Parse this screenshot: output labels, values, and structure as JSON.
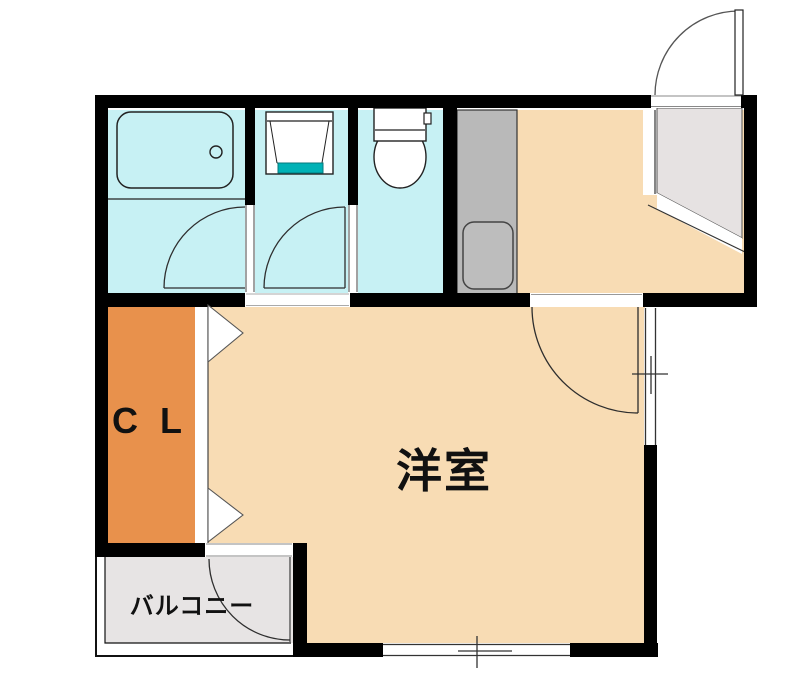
{
  "plan": {
    "type": "japanese-apartment-floor-plan",
    "labels": {
      "room": "洋室",
      "closet": "C L",
      "balcony": "バルコニー"
    },
    "fixtures": [
      "bathtub-icon",
      "bathtub-drain-icon",
      "washbasin-icon",
      "toilet-icon",
      "kitchen-sink-icon",
      "door-swing-arc",
      "folding-door-triangles",
      "window-cross-symbol"
    ],
    "colors": {
      "wall": "#000000",
      "wet_area_floor": "#c7f1f4",
      "main_floor": "#f8dcb4",
      "closet_floor": "#e8914c",
      "entry_step_floor": "#e6e2e2",
      "balcony_floor": "#e7e4e4",
      "kitchen_counter": "#b9b9b9",
      "sink": "#bdbdbd",
      "fixture_fill": "#ffffff",
      "accent_teal": "#00b2b6",
      "line": "#222222"
    }
  }
}
